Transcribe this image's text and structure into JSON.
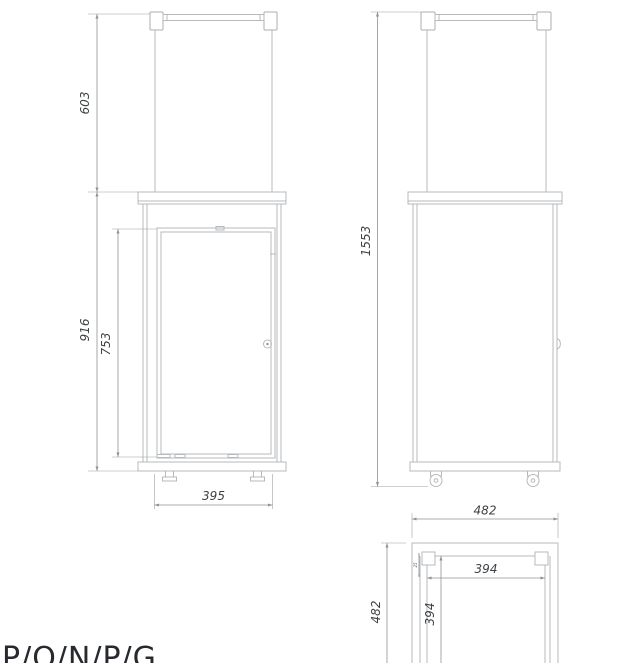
{
  "drawing": {
    "bottom_label": "P/O/N/P/G",
    "dims": {
      "front_glass_height": "603",
      "front_body_height": "916",
      "front_door_height": "753",
      "front_width": "395",
      "side_total_height": "1553",
      "plan_width": "482",
      "plan_depth": "482",
      "plan_inner_width": "394",
      "plan_inner_depth": "394",
      "plan_post_size": "25"
    },
    "colors": {
      "object_line": "#b6babd",
      "dimension_line": "#8e9296",
      "dimension_text": "#3f4245",
      "label_text": "#26292d"
    }
  }
}
